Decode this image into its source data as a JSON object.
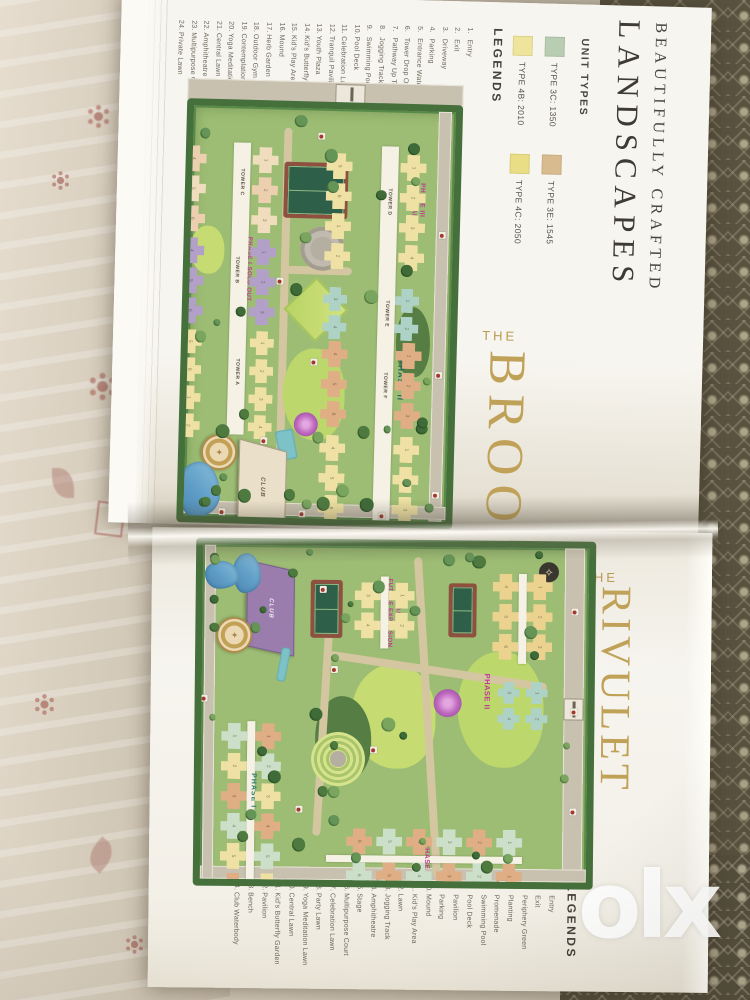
{
  "watermark": "olx",
  "heading": {
    "line1": "BEAUTIFULLY CRAFTED",
    "line2": "LANDSCAPES"
  },
  "unit_types": {
    "title": "UNIT TYPES",
    "items": [
      {
        "label": "TYPE 3C: 1350",
        "swatch": "#b9cdb2"
      },
      {
        "label": "TYPE 3E: 1545",
        "swatch": "#d8bb8e"
      },
      {
        "label": "TYPE 4B: 2010",
        "swatch": "#eee49c"
      },
      {
        "label": "TYPE 4C: 2050",
        "swatch": "#e9de85"
      }
    ]
  },
  "brook": {
    "the": "THE",
    "title": "BROOK",
    "legends_title": "LEGENDS",
    "legends": [
      "Entry",
      "Exit",
      "Driveway",
      "Parking",
      "Entrance Water Feature",
      "Tower Drop Off",
      "Pathway Up To Podium",
      "Jogging Track",
      "Swimming Pool",
      "Pool Deck",
      "Celebration Lawn",
      "Tranquil Pavilion",
      "Youth Plaza",
      "Kid's Butterfly Garden",
      "Kid's Play Area",
      "Mound",
      "Herb Garden",
      "Outdoor Gym",
      "Contemplation Pavilion",
      "Yoga Meditation Lawn",
      "Central Lawn",
      "Amphitheatre",
      "Multipurpose Court",
      "Private Lawn"
    ],
    "map": {
      "phase1": "PHASE I",
      "sold_out": "SOLD OUT",
      "phase2": "PHASE II",
      "phase3_line1": "PHASE III",
      "phase3_line2": "FUTURE EXPANSION",
      "club": "CLUB",
      "towers": [
        "TOWER C",
        "TOWER B",
        "TOWER A",
        "TOWER D",
        "TOWER E",
        "TOWER F"
      ],
      "unit_numbers": [
        "1",
        "2",
        "3",
        "4",
        "5",
        "6"
      ]
    }
  },
  "rivulet": {
    "the": "THE",
    "title": "RIVULET",
    "legends_title": "LEGENDS",
    "legends": [
      "Entry",
      "Exit",
      "Periphery Green",
      "Planting",
      "Promenade",
      "Swimming Pool",
      "Pool Deck",
      "Pavilion",
      "Parking",
      "Mound",
      "Kid's Play Area",
      "Lawn",
      "Jogging Track",
      "Amphitheatre",
      "Stage",
      "Multipurpose Court",
      "Celebration Lawn",
      "Party Lawn",
      "Yoga Meditation Lawn",
      "Central Lawn",
      "Kid's Butterfly Garden",
      "Pavilion",
      "Bench",
      "Club Waterbody"
    ],
    "map": {
      "phase1": "PHASE I",
      "phase2": "PHASE II",
      "phase3_line1": "PHASE III",
      "phase3_line2": "FUTURE EXPANSION",
      "club": "CLUB",
      "unit_numbers": [
        "1",
        "2",
        "3",
        "4",
        "5",
        "6"
      ]
    }
  },
  "colors": {
    "title_gold": "#c0a158",
    "phase_magenta": "#c13a92",
    "phase_teal": "#23645c",
    "tower_cream": "#f0ddbd",
    "tower_purple": "#b3a0c9",
    "tower_yellow": "#eee1a3",
    "tower_teal": "#aed3c6",
    "tower_orange": "#e0ae85",
    "tower_mint": "#cbdfc9",
    "club_purple": "#9a7cad",
    "marker_red": "#a43a2f"
  }
}
